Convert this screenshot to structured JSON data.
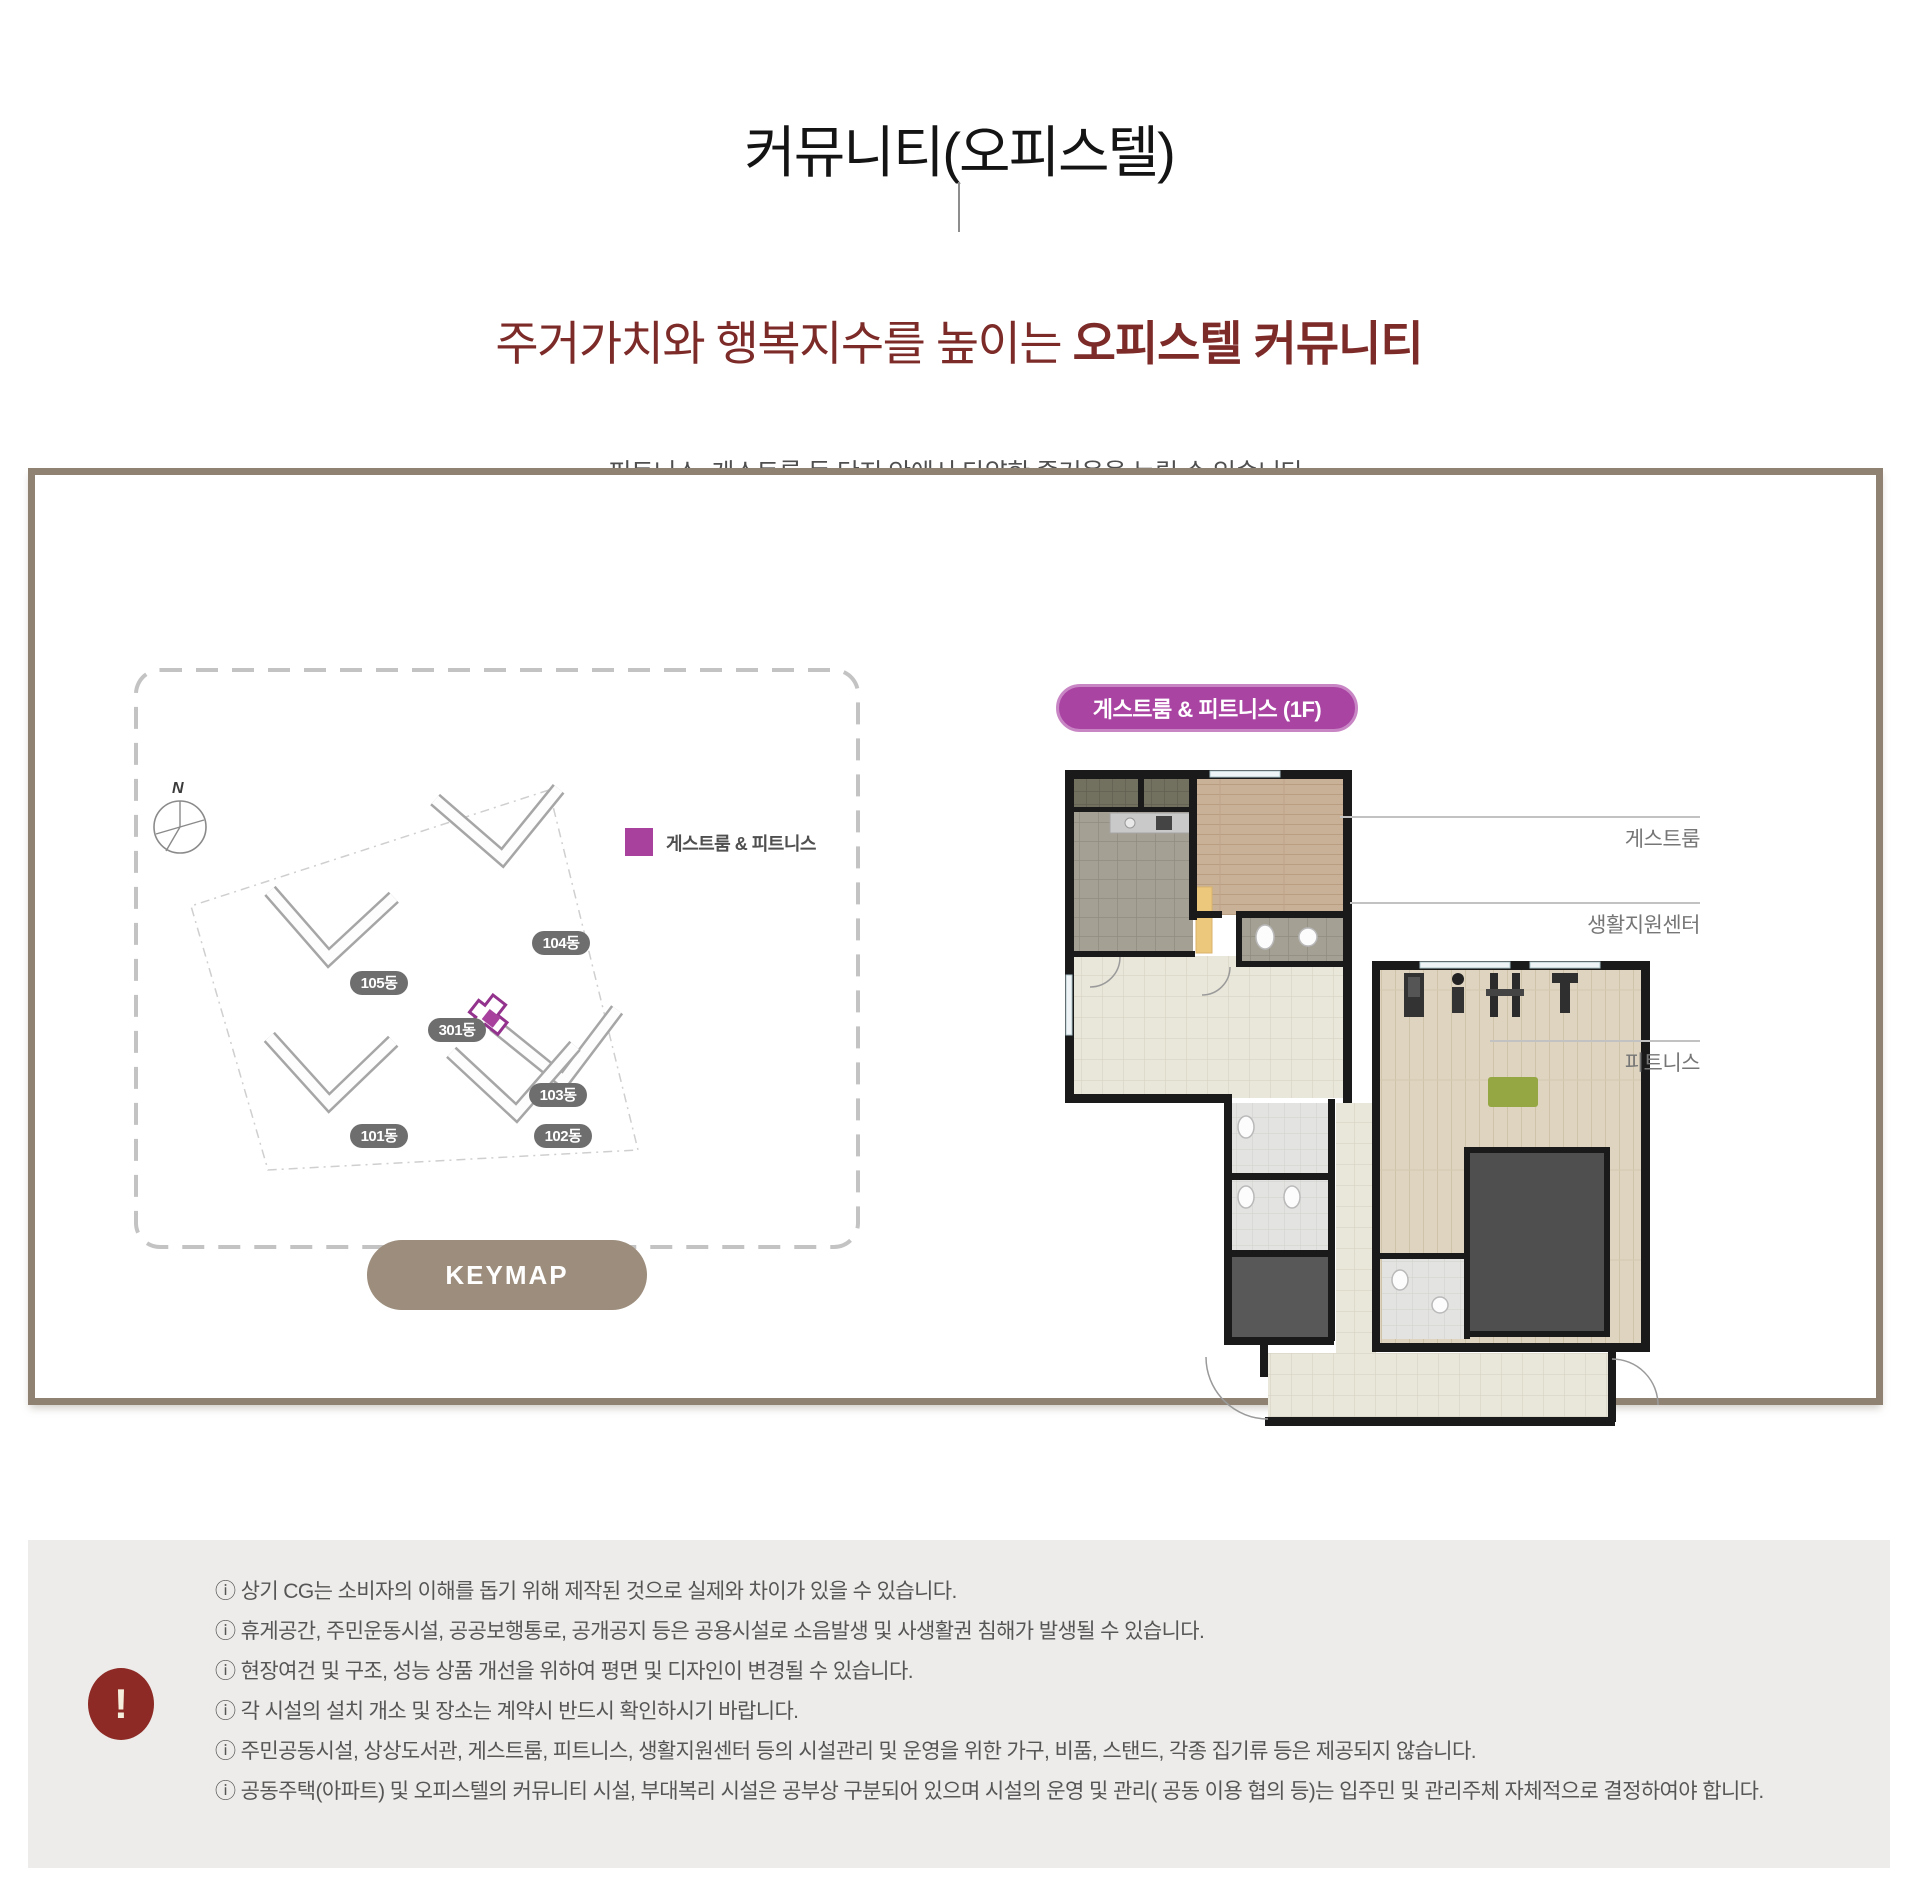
{
  "header": {
    "title": "커뮤니티(오피스텔)",
    "subtitle_normal": "주거가치와 행복지수를 높이는 ",
    "subtitle_strong": "오피스텔 커뮤니티",
    "description": "피트니스, 게스트룸 등 단지 안에서 다양한 즐거움을 누릴 수 있습니다."
  },
  "keymap": {
    "compass_label": "N",
    "legend": {
      "color": "#a8409e",
      "label": "게스트룸 & 피트니스"
    },
    "buildings": [
      "104동",
      "105동",
      "301동",
      "103동",
      "101동",
      "102동"
    ],
    "button_label": "KEYMAP"
  },
  "floorplan": {
    "badge_label": "게스트룸 & 피트니스 (1F)",
    "callouts": [
      "게스트룸",
      "생활지원센터",
      "피트니스"
    ]
  },
  "notice": {
    "icon": "!",
    "items": [
      "ⓘ 상기 CG는 소비자의 이해를 돕기 위해 제작된 것으로 실제와 차이가 있을 수 있습니다.",
      "ⓘ 휴게공간, 주민운동시설, 공공보행통로, 공개공지 등은 공용시설로 소음발생 및 사생활권 침해가 발생될 수 있습니다.",
      "ⓘ 현장여건 및 구조, 성능 상품 개선을 위하여 평면 및 디자인이 변경될 수 있습니다.",
      "ⓘ 각 시설의 설치 개소 및 장소는 계약시 반드시 확인하시기 바랍니다.",
      "ⓘ 주민공동시설, 상상도서관, 게스트룸, 피트니스, 생활지원센터 등의 시설관리 및 운영을 위한 가구, 비품, 스탠드, 각종 집기류 등은 제공되지 않습니다.",
      "ⓘ 공동주택(아파트) 및 오피스텔의 커뮤니티 시설, 부대복리 시설은 공부상 구분되어 있으며 시설의 운영 및 관리( 공동 이용 협의 등)는 입주민 및 관리주체 자체적으로 결정하여야 합니다."
    ]
  },
  "colors": {
    "accent_magenta": "#a8409e",
    "heading_red": "#7d2b29",
    "frame_taupe": "#8f8273",
    "keymap_button": "#9c8d7c",
    "warning_red": "#8d2a25",
    "notice_bg": "#edecea",
    "pill_gray": "#6e6e6e"
  }
}
